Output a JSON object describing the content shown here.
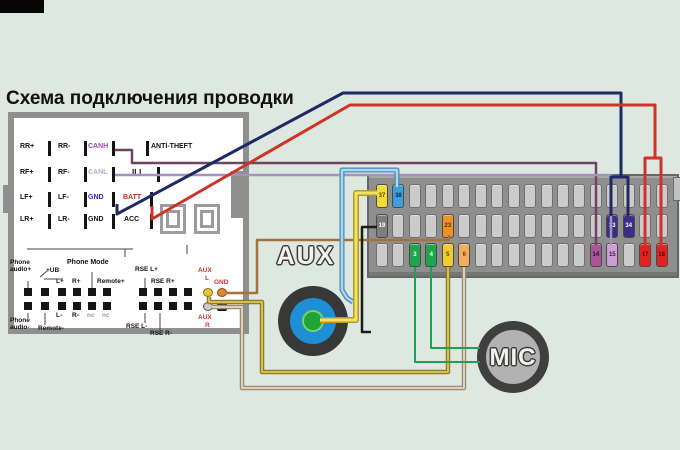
{
  "title": "Схема подключения проводки",
  "aux_jack": {
    "label": "AUX"
  },
  "mic": {
    "label": "MIC"
  },
  "colors": {
    "background": "#dce8e0",
    "panel_border": "#8f8f8f",
    "block_body": "#8f8f8f",
    "wire_navy": "#1d2a66",
    "wire_red": "#cf3327",
    "wire_canh": "#714463",
    "wire_ill": "#a393bd",
    "wire_blue": "#a6d9f2",
    "wire_yellow": "#f2e360",
    "wire_black": "#1b1b1b",
    "wire_brown": "#a5713d",
    "wire_khaki": "#d2bf55",
    "wire_tan": "#dcd0ba",
    "wire_green": "#1f9e55"
  },
  "radio_panel": {
    "rows": [
      {
        "y": 149,
        "labels": [
          {
            "t": "RR+",
            "x": 20
          },
          {
            "t": "RR-",
            "x": 58
          },
          {
            "t": "CANH",
            "x": 88,
            "c": "#9a4f9a"
          },
          {
            "t": "ANTI-THEFT",
            "x": 151
          }
        ],
        "bars": [
          48,
          84,
          112,
          146
        ]
      },
      {
        "y": 175,
        "labels": [
          {
            "t": "RF+",
            "x": 20
          },
          {
            "t": "RF-",
            "x": 58
          },
          {
            "t": "CANL",
            "x": 88,
            "c": "#bcaccb"
          },
          {
            "t": "ILL",
            "x": 132,
            "s": 8
          }
        ],
        "bars": [
          48,
          84,
          112,
          157
        ]
      },
      {
        "y": 200,
        "labels": [
          {
            "t": "LF+",
            "x": 20
          },
          {
            "t": "LF-",
            "x": 58
          },
          {
            "t": "GND",
            "x": 88,
            "c": "#2a2ac8"
          },
          {
            "t": "BATT",
            "x": 123,
            "c": "#cc2a2a"
          }
        ],
        "bars": [
          48,
          84,
          112,
          150
        ]
      },
      {
        "y": 222,
        "labels": [
          {
            "t": "LR+",
            "x": 20
          },
          {
            "t": "LR-",
            "x": 58
          },
          {
            "t": "GND",
            "x": 88
          },
          {
            "t": "ACC",
            "x": 124
          }
        ],
        "bars": [
          48,
          84,
          112,
          150
        ]
      }
    ],
    "phone_labels": [
      {
        "t": "Phone",
        "x": 10,
        "y": 260
      },
      {
        "t": "audio+",
        "x": 10,
        "y": 267
      },
      {
        "t": "+UB",
        "x": 46,
        "y": 268
      },
      {
        "t": "L+",
        "x": 56,
        "y": 279
      },
      {
        "t": "R+",
        "x": 72,
        "y": 279
      },
      {
        "t": "Phone Mode",
        "x": 67,
        "y": 259,
        "s": 7
      },
      {
        "t": "Remote+",
        "x": 97,
        "y": 279
      },
      {
        "t": "RSE L+",
        "x": 135,
        "y": 267
      },
      {
        "t": "RSE R+",
        "x": 151,
        "y": 279
      },
      {
        "t": "AUX",
        "x": 198,
        "y": 268,
        "c": "#cc3333"
      },
      {
        "t": "L",
        "x": 205,
        "y": 276,
        "c": "#cc3333"
      },
      {
        "t": "GND",
        "x": 214,
        "y": 280,
        "c": "#cc3333"
      },
      {
        "t": "L-",
        "x": 56,
        "y": 313
      },
      {
        "t": "R-",
        "x": 72,
        "y": 313
      },
      {
        "t": "nc",
        "x": 87,
        "y": 313,
        "c": "#999999"
      },
      {
        "t": "nc",
        "x": 102,
        "y": 313,
        "c": "#999999"
      },
      {
        "t": "Phone",
        "x": 10,
        "y": 318
      },
      {
        "t": "audio-",
        "x": 10,
        "y": 325
      },
      {
        "t": "Remote-",
        "x": 38,
        "y": 326
      },
      {
        "t": "RSE L-",
        "x": 126,
        "y": 324
      },
      {
        "t": "RSE R-",
        "x": 150,
        "y": 331
      },
      {
        "t": "AUX",
        "x": 198,
        "y": 315,
        "c": "#cc3333"
      },
      {
        "t": "R",
        "x": 205,
        "y": 323,
        "c": "#cc3333"
      }
    ],
    "pin_grid": {
      "top_y": 288,
      "bottom_y": 302,
      "xs": [
        24,
        41,
        58,
        73,
        88,
        103,
        139,
        154,
        169,
        184
      ]
    },
    "special_pins": [
      {
        "name": "aux-l-pin",
        "x": 203,
        "y": 288,
        "bg": "#e6c53a",
        "br": "#8a7010",
        "round": true
      },
      {
        "name": "gnd-pin",
        "x": 217,
        "y": 288,
        "bg": "#e0862e",
        "br": "#8a4a10",
        "round": true
      },
      {
        "name": "aux-r-pin",
        "x": 203,
        "y": 302,
        "bg": "#cccccc",
        "br": "#555555",
        "round": true
      },
      {
        "name": "nc-pin",
        "x": 217,
        "y": 302,
        "bg": "#141414",
        "br": "#141414",
        "round": false
      }
    ]
  },
  "connector_block": {
    "x": 367,
    "y": 174,
    "w": 312,
    "h": 104,
    "rows_y": [
      184,
      214,
      243
    ],
    "slot_w": 12,
    "slot_h": 24,
    "x0": 376,
    "pitch": 16.45,
    "slots_per_row": 18,
    "colored_pins": [
      {
        "row": 0,
        "idx": 0,
        "num": "37",
        "bg": "#f0dc35",
        "fg": "#5a4a00"
      },
      {
        "row": 0,
        "idx": 1,
        "num": "38",
        "bg": "#3f9fd8",
        "fg": "#0a2a5a"
      },
      {
        "row": 1,
        "idx": 0,
        "num": "19",
        "bg": "#7d7d7d",
        "fg": "#ffffff"
      },
      {
        "row": 1,
        "idx": 4,
        "num": "23",
        "bg": "#ef9225",
        "fg": "#5a3000"
      },
      {
        "row": 1,
        "idx": 14,
        "num": "33",
        "bg": "#3a2d85",
        "fg": "#ffffff"
      },
      {
        "row": 1,
        "idx": 15,
        "num": "34",
        "bg": "#3a2d85",
        "fg": "#ffffff"
      },
      {
        "row": 2,
        "idx": 2,
        "num": "3",
        "bg": "#21a350",
        "fg": "#ffffff"
      },
      {
        "row": 2,
        "idx": 3,
        "num": "4",
        "bg": "#21a350",
        "fg": "#ffffff"
      },
      {
        "row": 2,
        "idx": 4,
        "num": "5",
        "bg": "#f0cc30",
        "fg": "#5a4a00"
      },
      {
        "row": 2,
        "idx": 5,
        "num": "6",
        "bg": "#efae62",
        "fg": "#7a4000"
      },
      {
        "row": 2,
        "idx": 13,
        "num": "14",
        "bg": "#a9549b",
        "fg": "#30082a"
      },
      {
        "row": 2,
        "idx": 14,
        "num": "15",
        "bg": "#cd9fd7",
        "fg": "#45123f"
      },
      {
        "row": 2,
        "idx": 16,
        "num": "17",
        "bg": "#e32222",
        "fg": "#5a0505"
      },
      {
        "row": 2,
        "idx": 17,
        "num": "18",
        "bg": "#e32222",
        "fg": "#5a0505"
      }
    ]
  },
  "wires": [
    {
      "name": "panel-line",
      "color": "#444444",
      "w": 1,
      "points": [
        [
          27,
          249
        ],
        [
          133,
          249
        ]
      ]
    },
    {
      "name": "panel-line",
      "color": "#444444",
      "w": 1,
      "points": [
        [
          125,
          249
        ],
        [
          125,
          257
        ]
      ]
    },
    {
      "name": "panel-line",
      "color": "#444444",
      "w": 1,
      "points": [
        [
          187,
          245
        ],
        [
          187,
          254
        ]
      ]
    },
    {
      "name": "phone-mode-pointer",
      "color": "#444444",
      "w": 1,
      "points": [
        [
          92,
          272
        ],
        [
          92,
          288
        ]
      ]
    },
    {
      "name": "ub-underline",
      "color": "#444444",
      "w": 1,
      "points": [
        [
          44,
          279
        ],
        [
          63,
          279
        ]
      ]
    },
    {
      "name": "ub-switch-tick",
      "color": "#444444",
      "w": 1,
      "points": [
        [
          40,
          277
        ],
        [
          47,
          271
        ]
      ]
    },
    {
      "name": "panel-pointer",
      "color": "#444444",
      "w": 1,
      "points": [
        [
          28,
          281
        ],
        [
          28,
          288
        ]
      ]
    },
    {
      "name": "panel-pointer",
      "color": "#444444",
      "w": 1,
      "points": [
        [
          145,
          278
        ],
        [
          145,
          288
        ]
      ]
    },
    {
      "name": "panel-pointer",
      "color": "#444444",
      "w": 1,
      "points": [
        [
          28,
          313
        ],
        [
          28,
          318
        ]
      ]
    },
    {
      "name": "panel-pointer",
      "color": "#444444",
      "w": 1,
      "points": [
        [
          45,
          313
        ],
        [
          45,
          325
        ]
      ]
    },
    {
      "name": "panel-pointer",
      "color": "#444444",
      "w": 1,
      "points": [
        [
          145,
          313
        ],
        [
          145,
          323
        ]
      ]
    },
    {
      "name": "panel-pointer",
      "color": "#444444",
      "w": 1,
      "points": [
        [
          160,
          313
        ],
        [
          160,
          330
        ]
      ]
    },
    {
      "name": "aux-gnd-to-pin-23-wire",
      "color": "#a5713d",
      "w": 2.5,
      "points": [
        [
          226,
          293
        ],
        [
          257,
          293
        ],
        [
          257,
          240
        ],
        [
          449,
          240
        ],
        [
          449,
          235
        ]
      ]
    },
    {
      "name": "canh-to-pin-14-wire",
      "color": "#714463",
      "w": 2.5,
      "points": [
        [
          115,
          150
        ],
        [
          132,
          150
        ],
        [
          132,
          163
        ],
        [
          596,
          163
        ],
        [
          596,
          245
        ]
      ]
    },
    {
      "name": "ill-to-pin-15-wire",
      "color": "#a393bd",
      "w": 2.5,
      "points": [
        [
          115,
          175
        ],
        [
          611,
          175
        ],
        [
          611,
          245
        ]
      ]
    },
    {
      "name": "gnd-to-pins-33-34-wire",
      "color": "#1d2a66",
      "w": 3,
      "points": [
        [
          117,
          204
        ],
        [
          117,
          214
        ],
        [
          343,
          93
        ],
        [
          621,
          93
        ],
        [
          621,
          177
        ]
      ]
    },
    {
      "name": "gnd-to-pins-33-34-wire-branch",
      "color": "#1d2a66",
      "w": 3,
      "points": [
        [
          611,
          216
        ],
        [
          611,
          177
        ],
        [
          628,
          177
        ],
        [
          628,
          216
        ]
      ]
    },
    {
      "name": "batt-to-pins-17-18-wire",
      "color": "#cf3327",
      "w": 3,
      "points": [
        [
          152,
          206
        ],
        [
          152,
          219
        ],
        [
          350,
          105
        ],
        [
          655,
          105
        ],
        [
          655,
          158
        ]
      ]
    },
    {
      "name": "batt-to-pins-17-18-wire-branch",
      "color": "#cf3327",
      "w": 3,
      "points": [
        [
          645,
          246
        ],
        [
          645,
          158
        ],
        [
          661,
          158
        ],
        [
          661,
          246
        ]
      ]
    },
    {
      "name": "pin-38-to-aux-ring-wire-outline",
      "color": "#4d86b5",
      "w": 5,
      "points": [
        [
          397,
          187
        ],
        [
          397,
          170
        ],
        [
          342,
          170
        ],
        [
          342,
          290
        ],
        [
          347,
          298
        ],
        [
          353,
          302
        ]
      ]
    },
    {
      "name": "pin-38-to-aux-ring-wire",
      "color": "#a6d9f2",
      "w": 2.5,
      "points": [
        [
          397,
          187
        ],
        [
          397,
          170
        ],
        [
          342,
          170
        ],
        [
          342,
          290
        ],
        [
          347,
          298
        ],
        [
          353,
          302
        ]
      ]
    },
    {
      "name": "pin-37-to-aux-tip-wire-outline",
      "color": "#b09a28",
      "w": 6,
      "points": [
        [
          377,
          193
        ],
        [
          356,
          193
        ],
        [
          356,
          320
        ],
        [
          320,
          320
        ]
      ]
    },
    {
      "name": "pin-37-to-aux-tip-wire",
      "color": "#f2e360",
      "w": 3,
      "points": [
        [
          377,
          193
        ],
        [
          356,
          193
        ],
        [
          356,
          320
        ],
        [
          320,
          320
        ]
      ]
    },
    {
      "name": "pin-19-to-aux-sleeve-wire",
      "color": "#1b1b1b",
      "w": 2.5,
      "points": [
        [
          377,
          227
        ],
        [
          362,
          227
        ],
        [
          362,
          332
        ],
        [
          371,
          332
        ]
      ]
    },
    {
      "name": "aux-l-to-pin-5-wire-outline",
      "color": "#8f7d22",
      "w": 4.5,
      "points": [
        [
          209,
          297
        ],
        [
          209,
          302
        ],
        [
          262,
          302
        ],
        [
          262,
          372
        ],
        [
          448,
          372
        ],
        [
          448,
          267
        ]
      ]
    },
    {
      "name": "aux-l-to-pin-5-wire",
      "color": "#d2bf55",
      "w": 2,
      "points": [
        [
          209,
          297
        ],
        [
          209,
          302
        ],
        [
          262,
          302
        ],
        [
          262,
          372
        ],
        [
          448,
          372
        ],
        [
          448,
          267
        ]
      ]
    },
    {
      "name": "aux-r-to-pin-6-wire-outline",
      "color": "#9a8c72",
      "w": 4.5,
      "points": [
        [
          212,
          307
        ],
        [
          242,
          307
        ],
        [
          242,
          388
        ],
        [
          464,
          388
        ],
        [
          464,
          267
        ]
      ]
    },
    {
      "name": "aux-r-to-pin-6-wire",
      "color": "#dcd0ba",
      "w": 2,
      "points": [
        [
          212,
          307
        ],
        [
          242,
          307
        ],
        [
          242,
          388
        ],
        [
          464,
          388
        ],
        [
          464,
          267
        ]
      ]
    },
    {
      "name": "pin-3-to-mic-wire",
      "color": "#1f9e55",
      "w": 2,
      "points": [
        [
          415,
          267
        ],
        [
          415,
          362
        ],
        [
          480,
          362
        ]
      ]
    },
    {
      "name": "pin-4-to-mic-wire",
      "color": "#1f9e55",
      "w": 2,
      "points": [
        [
          431,
          267
        ],
        [
          431,
          348
        ],
        [
          480,
          348
        ]
      ]
    }
  ]
}
